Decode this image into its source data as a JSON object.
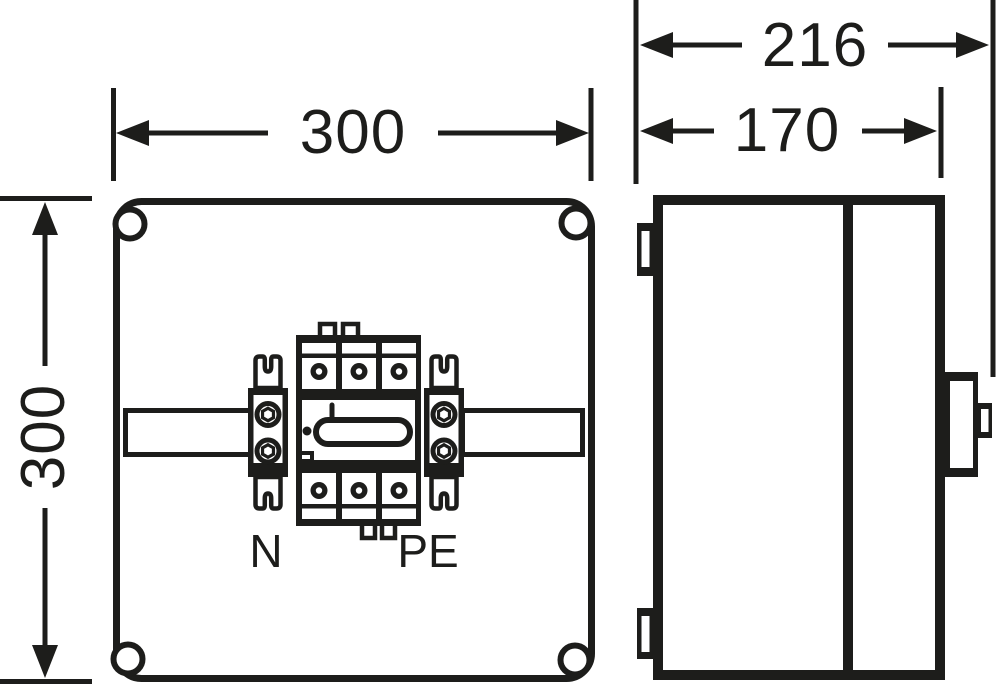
{
  "drawing": {
    "front_view": {
      "width_mm": "300",
      "height_mm": "300",
      "label_neutral": "N",
      "label_protective_earth": "PE"
    },
    "side_view": {
      "depth_total_mm": "216",
      "depth_body_mm": "170"
    },
    "colors": {
      "line": "#1d1d1b",
      "background": "#ffffff"
    }
  }
}
